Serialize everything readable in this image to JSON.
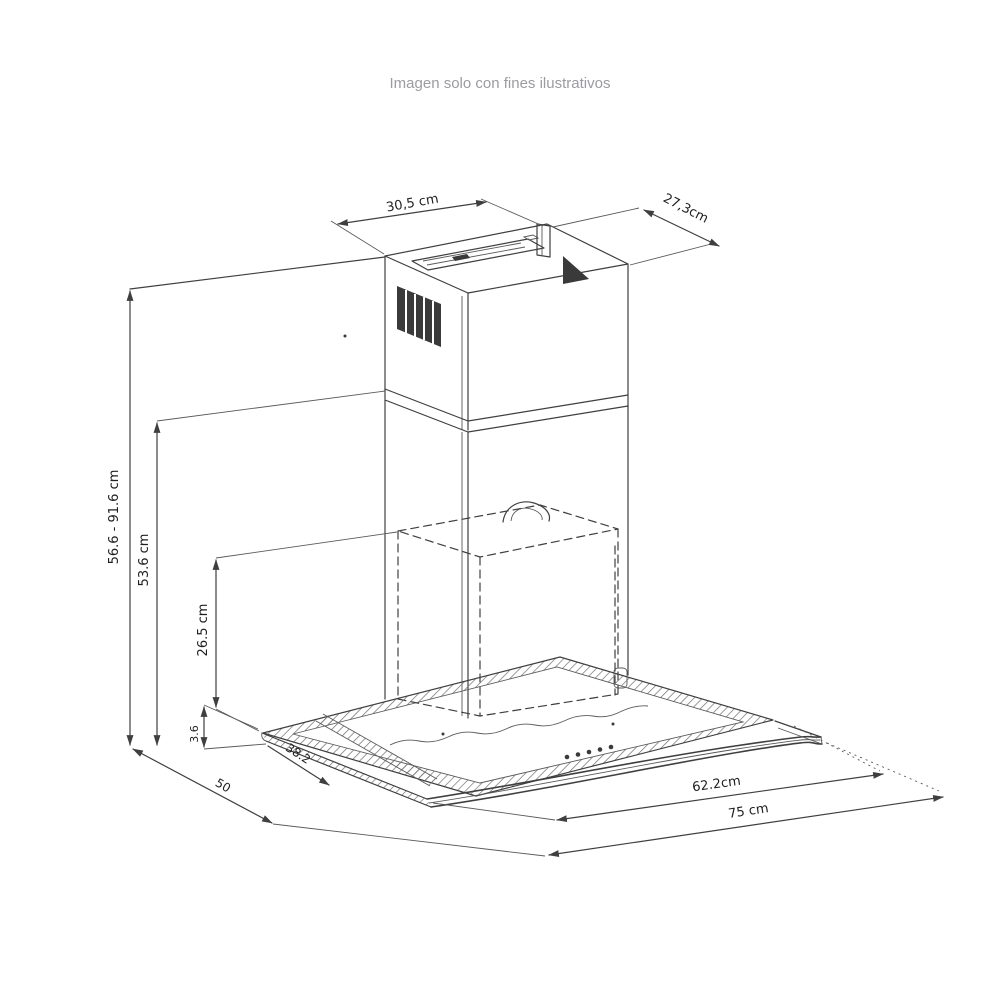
{
  "caption": "Imagen solo con fines ilustrativos",
  "drawing": {
    "type": "technical-dimension-diagram",
    "subject": "campana extractora de pared con visor de vidrio curvo",
    "line_color": "#3f3f3f",
    "caption_color": "#9b9ba1",
    "background": "#ffffff"
  },
  "dims": {
    "duct_top_width": "30,5 cm",
    "duct_top_depth": "27,3cm",
    "total_height": "56.6 - 91.6 cm",
    "chimney_height": "53.6 cm",
    "body_height": "26.5 cm",
    "glass_edge_thickness": "3.6",
    "glass_depth": "38.2",
    "base_depth": "50",
    "glass_width": "62.2cm",
    "total_width": "75 cm"
  }
}
